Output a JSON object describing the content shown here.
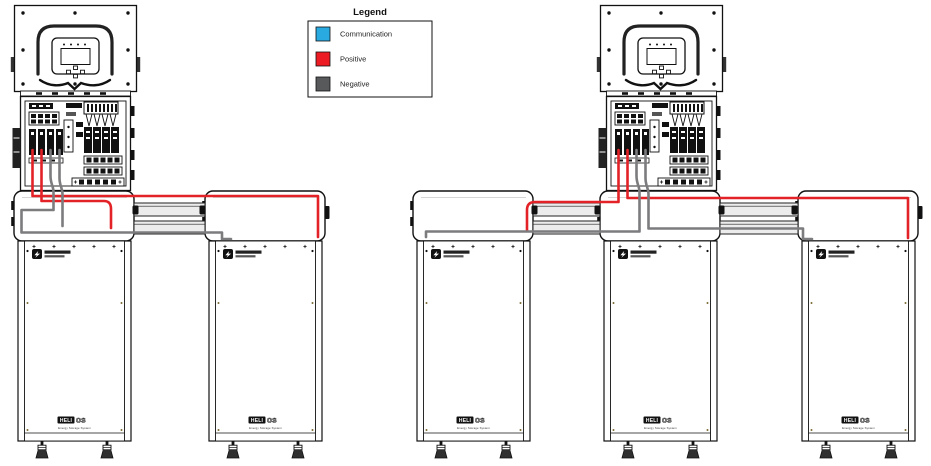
{
  "legend": {
    "title": "Legend",
    "items": [
      {
        "label": "Communication",
        "color": "#29ABE2"
      },
      {
        "label": "Positive",
        "color": "#ED1C24"
      },
      {
        "label": "Negative",
        "color": "#58595B"
      }
    ]
  },
  "wire_colors": {
    "positive": "#E32228",
    "negative": "#7C7C7E"
  },
  "rail_color": "#ECECEC",
  "product_label": {
    "primary": "HELI",
    "secondary": "OS",
    "full_name": "HELIOS",
    "tagline": "Energy Storage System"
  },
  "systems": [
    {
      "inverter_count": 1,
      "battery_count": 2
    },
    {
      "inverter_count": 1,
      "battery_count": 3
    }
  ]
}
